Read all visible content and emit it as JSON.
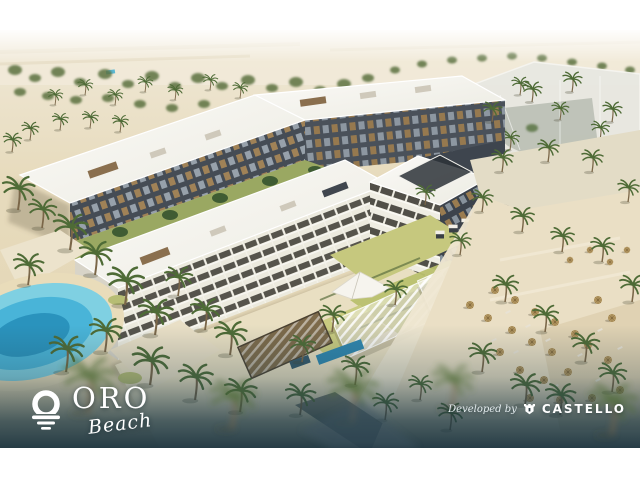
{
  "branding": {
    "project": {
      "icon": "sun-over-waves-icon",
      "name": "ORO",
      "script": "Beach"
    },
    "developer": {
      "label": "Developed by",
      "icon": "castle-shield-icon",
      "name": "CASTELLO"
    }
  },
  "scene": {
    "description": "Aerial architectural rendering of a U-shaped beachfront residential resort: white-roofed wings with dark balconied facades around a landscaped courtyard with pergolas, canopies and lap pools; palm-filled beach with thatched umbrellas and loungers; turquoise lagoon pool at lower left; ghosted future-phase building at upper right; hazy desert horizon."
  },
  "colors": {
    "sky_haze": "#f4f0e6",
    "sand": "#e5d8ba",
    "beach_sand": "#eadfc5",
    "building_white": "#f6f5f1",
    "facade_dark": "#434a53",
    "balcony_bronze": "#a08257",
    "palm_green": "#4e6b36",
    "lawn_green": "#c3c67c",
    "pool_turquoise": "#45b0d6",
    "lagoon_blue": "#2f9ec7",
    "ghost_building": "#e8e8e3",
    "overlay_teal": "#1a323e",
    "logo_white": "#ffffff"
  }
}
